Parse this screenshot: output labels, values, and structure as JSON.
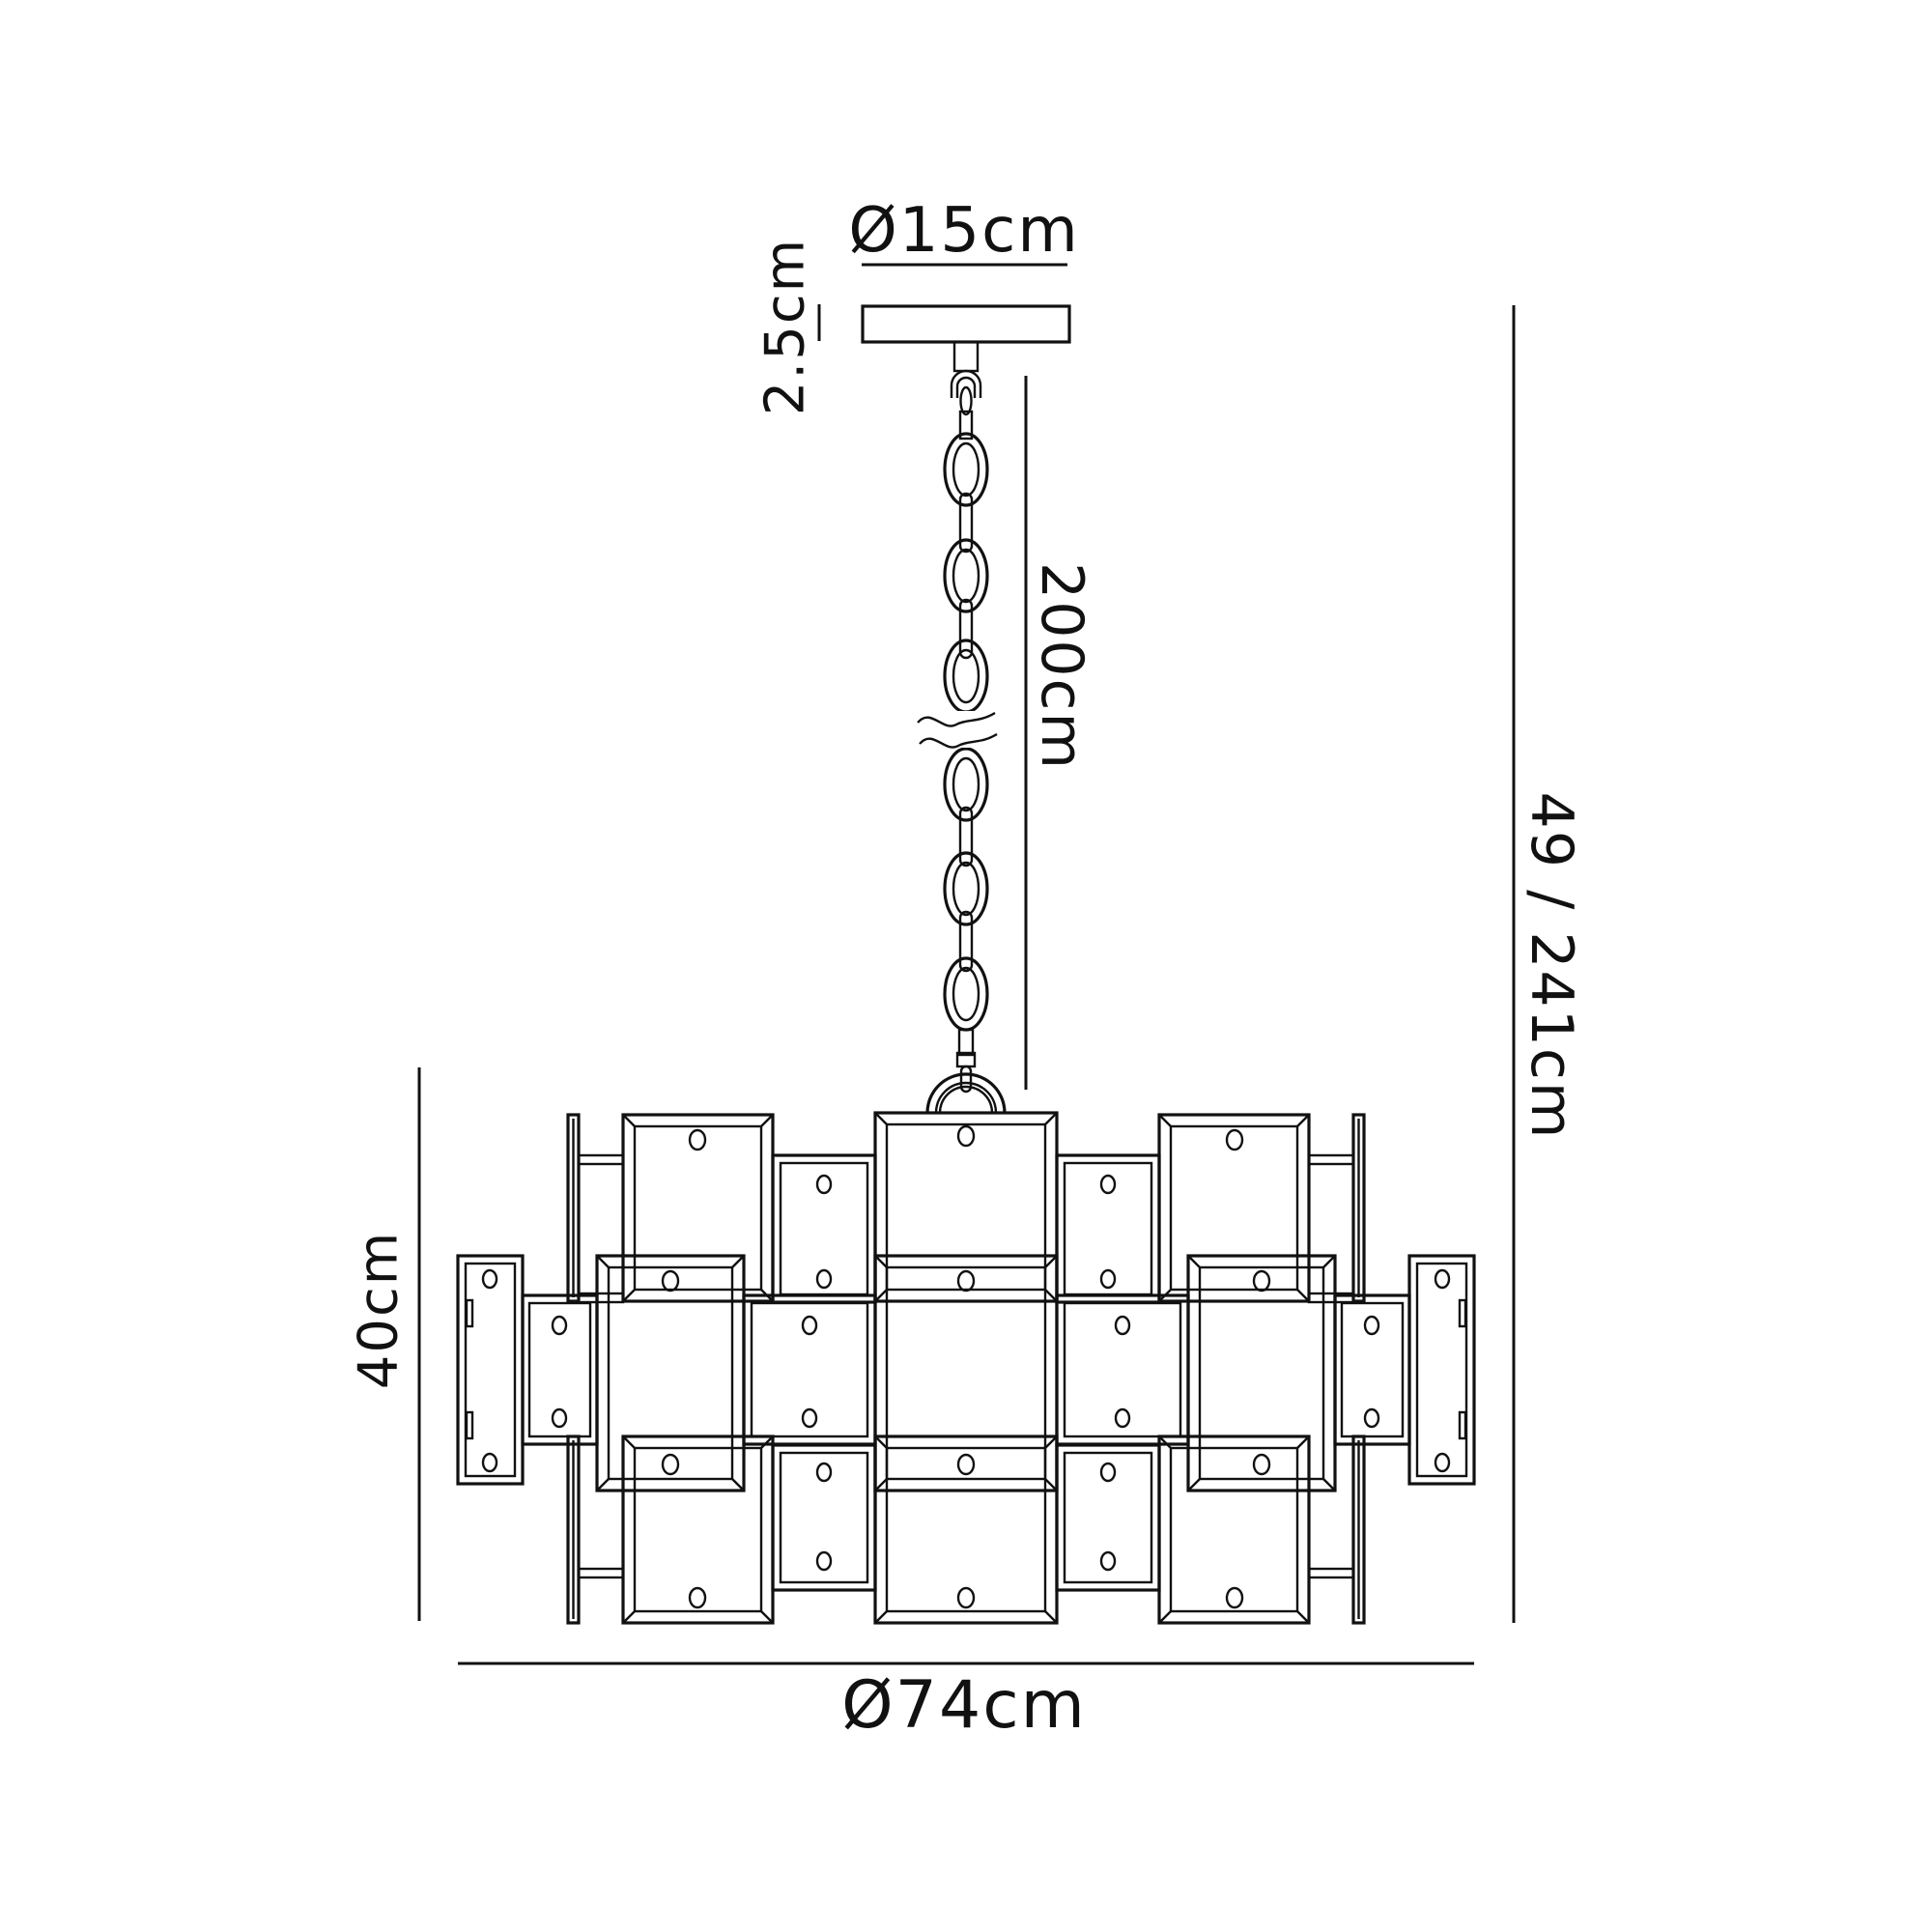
{
  "diagram": {
    "type": "product-dimension-drawing",
    "subject": "chandelier pendant with ceiling canopy and chain suspension",
    "background_color": "#ffffff",
    "line_color": "#111111",
    "labels": {
      "canopy_diameter": "Ø15cm",
      "canopy_height": "2.5cm",
      "chain_length": "200cm",
      "overall_height": "49 / 241cm",
      "body_height": "40cm",
      "body_diameter": "Ø74cm"
    }
  }
}
